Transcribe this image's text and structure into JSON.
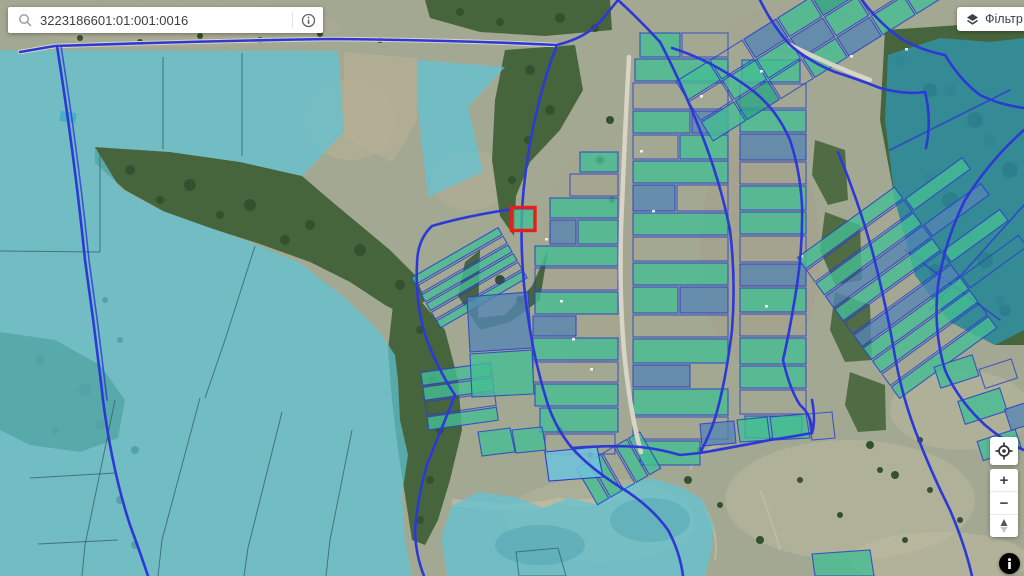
{
  "search_bar": {
    "value": "3223186601:01:001:0016",
    "left_icon": "search-icon",
    "right_icon": "info-icon"
  },
  "filter_button": {
    "label": "Фільтр",
    "icon": "layers-icon"
  },
  "map_controls": {
    "geolocate_icon": "target-icon",
    "zoom_in_label": "+",
    "zoom_out_label": "−",
    "compass_icon": "north-needle-icon",
    "info_icon": "info-icon"
  },
  "map": {
    "selected_parcel_color": "#e3201b",
    "overlay_cyan": "#5fc4d6",
    "overlay_cyan_dark": "#2f95ac",
    "parcel_teal": "#45bd92",
    "parcel_blue": "#5585b2",
    "road_blue": "#2d39d6",
    "forest_green": "#47653c"
  }
}
